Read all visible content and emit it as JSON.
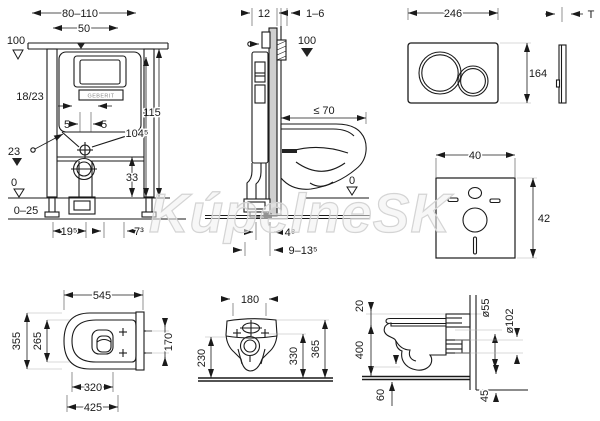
{
  "watermark": "KúpelneSK",
  "panels": {
    "frame_front": {
      "wall_width": "80–110",
      "cistern_width": "50",
      "meter_mark": "100",
      "fill_level": "18/23",
      "offset_left": "5",
      "offset_right": "5",
      "level_mark": "23",
      "total_height": "115",
      "cistern_top_height": "104⁵",
      "drain_height": "33",
      "zero_mark": "0",
      "floor_range": "0–25",
      "dim_left": "19⁵",
      "dim_right": "7³",
      "logo": "GEBERIT"
    },
    "frame_side": {
      "frame_depth": "12",
      "panel_thickness": "1–6",
      "meter_mark": "100",
      "bowl_depth_max": "≤ 70",
      "zero_mark": "0",
      "wall_offset": "4⁸",
      "drain_offset": "9–13⁵"
    },
    "flush_plate": {
      "width": "246",
      "height": "164",
      "thickness": "T"
    },
    "insulation_mat": {
      "width": "40",
      "height": "42"
    },
    "wc_top": {
      "depth": "545",
      "width": "355",
      "seat_width": "265",
      "inner_length": "320",
      "total_length": "425",
      "fixing_distance": "170"
    },
    "wc_rear": {
      "fixing_width": "180",
      "height_bottom": "230",
      "height_mid": "330",
      "height_top": "365"
    },
    "wc_side": {
      "seat_offset": "20",
      "mount_height": "400",
      "floor_depth": "60",
      "inlet_diameter": "ø55",
      "outlet_diameter": "ø102",
      "ledge": "45"
    }
  }
}
